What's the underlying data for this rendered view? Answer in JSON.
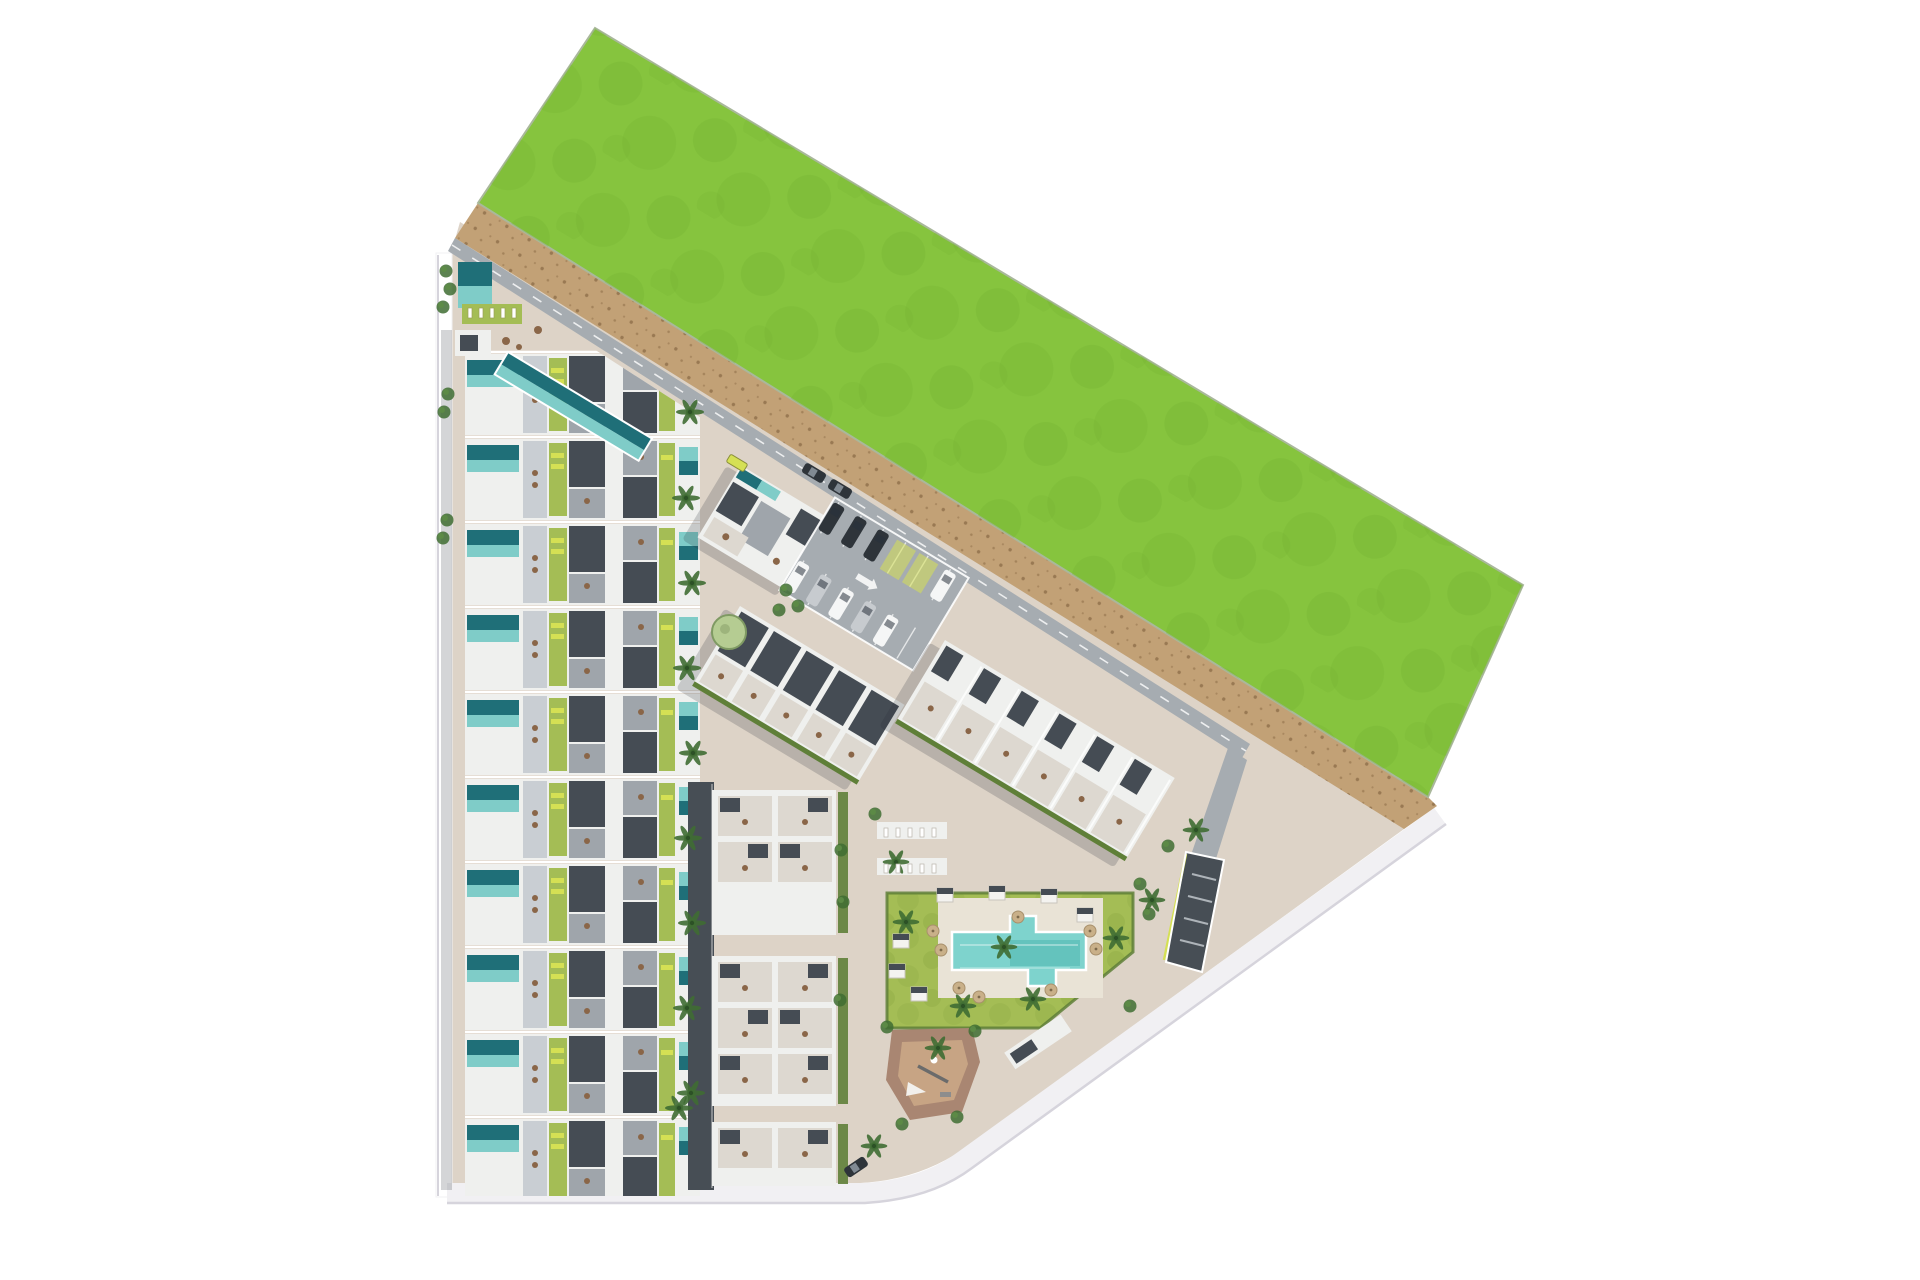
{
  "scene": {
    "name": "aerial-site-plan-rendering",
    "description": "Top-down 3D render of a coastal residential development: rows of townhouses with private pools on the left, rotated apartment blocks and parking in the centre, a communal lawn with swimming pool and playground on the right, a large green field to the north-east and a sandy dune strip along the boundary.",
    "width": 1920,
    "height": 1280
  },
  "colors": {
    "page_bg": "#ffffff",
    "grass": "#86c43e",
    "grass_dark": "#6fae2f",
    "sand": "#c2a176",
    "sand_dark": "#8f6f4a",
    "pavement": "#ddd3c7",
    "road_gray": "#a6acb1",
    "road_dark": "#474e55",
    "boundary_road": "#f1f0f3",
    "boundary_edge": "#d6d4dc",
    "roof_white": "#eff0ee",
    "roof_dark": "#454c54",
    "roof_mid": "#9fa5ab",
    "roof_light": "#c9ced3",
    "terrace": "#ddd8d0",
    "pool_dark": "#1f6f78",
    "pool_light": "#7fccc8",
    "big_pool": "#7ed3cd",
    "big_pool_deep": "#4fb7b0",
    "pool_deck": "#e9e3d6",
    "lawn": "#a4bd55",
    "lawn_dark": "#8aa743",
    "hedge": "#5f7f38",
    "tree_dark": "#3f6d33",
    "tree_pale": "#b5cc92",
    "accent": "#d5e054",
    "furniture_brown": "#8a6648",
    "playground_base": "#a98672",
    "playground_inner": "#c7a484",
    "umbrella": "#c9b089",
    "car_white": "#f5f6f6",
    "car_silver": "#c7cbcf",
    "car_dark": "#2e343a",
    "shadow": "rgba(40,45,55,0.20)"
  },
  "villas": {
    "rows": 10,
    "start_y": 352,
    "pitch": 85,
    "x": 465,
    "width": 235,
    "row_rects": [
      {
        "x": 0,
        "y": 2,
        "w": 235,
        "h": 81,
        "c": "f-rw"
      },
      {
        "x": 2,
        "y": 8,
        "w": 52,
        "h": 15,
        "c": "f-poold"
      },
      {
        "x": 2,
        "y": 23,
        "w": 52,
        "h": 12,
        "c": "f-pooll"
      },
      {
        "x": 58,
        "y": 4,
        "w": 24,
        "h": 77,
        "c": "f-rl"
      },
      {
        "x": 84,
        "y": 6,
        "w": 18,
        "h": 73,
        "c": "f-lawn"
      },
      {
        "x": 86,
        "y": 16,
        "w": 13,
        "h": 5,
        "c": "f-acc"
      },
      {
        "x": 86,
        "y": 27,
        "w": 13,
        "h": 5,
        "c": "f-acc"
      },
      {
        "x": 104,
        "y": 4,
        "w": 36,
        "h": 46,
        "c": "f-rd"
      },
      {
        "x": 104,
        "y": 52,
        "w": 36,
        "h": 29,
        "c": "f-rm"
      },
      {
        "x": 142,
        "y": 28,
        "w": 14,
        "h": 28,
        "c": "f-rw"
      },
      {
        "x": 158,
        "y": 4,
        "w": 34,
        "h": 34,
        "c": "f-rm"
      },
      {
        "x": 158,
        "y": 40,
        "w": 34,
        "h": 41,
        "c": "f-rd"
      },
      {
        "x": 194,
        "y": 6,
        "w": 16,
        "h": 73,
        "c": "f-lawn"
      },
      {
        "x": 196,
        "y": 18,
        "w": 12,
        "h": 5,
        "c": "f-acc"
      },
      {
        "x": 214,
        "y": 10,
        "w": 19,
        "h": 14,
        "c": "f-pooll"
      },
      {
        "x": 214,
        "y": 24,
        "w": 19,
        "h": 14,
        "c": "f-poold"
      }
    ],
    "row_dots": [
      [
        70,
        36
      ],
      [
        70,
        48
      ],
      [
        122,
        64
      ],
      [
        176,
        20
      ]
    ]
  },
  "decor": {
    "palms": [
      [
        690,
        412
      ],
      [
        686,
        498
      ],
      [
        692,
        583
      ],
      [
        687,
        668
      ],
      [
        693,
        753
      ],
      [
        688,
        838
      ],
      [
        692,
        923
      ],
      [
        687,
        1008
      ],
      [
        691,
        1093
      ],
      [
        679,
        1108
      ]
    ],
    "lawn_palms": [
      [
        1004,
        947
      ],
      [
        963,
        1006
      ],
      [
        1033,
        999
      ],
      [
        906,
        922
      ],
      [
        1116,
        938
      ],
      [
        938,
        1048
      ],
      [
        1152,
        900
      ],
      [
        874,
        1146
      ],
      [
        896,
        862
      ],
      [
        1196,
        830
      ]
    ],
    "round_trees": [
      [
        729,
        632
      ]
    ],
    "bushes": [
      [
        446,
        271
      ],
      [
        450,
        289
      ],
      [
        443,
        307
      ],
      [
        448,
        394
      ],
      [
        444,
        412
      ],
      [
        447,
        520
      ],
      [
        443,
        538
      ],
      [
        786,
        590
      ],
      [
        798,
        606
      ],
      [
        779,
        610
      ],
      [
        841,
        850
      ],
      [
        843,
        902
      ],
      [
        840,
        1000
      ],
      [
        1140,
        884
      ],
      [
        1149,
        914
      ],
      [
        1130,
        1006
      ],
      [
        975,
        1031
      ],
      [
        887,
        1027
      ],
      [
        902,
        1124
      ],
      [
        957,
        1117
      ],
      [
        1168,
        846
      ],
      [
        875,
        814
      ]
    ],
    "cabanas": [
      [
        945,
        895
      ],
      [
        997,
        893
      ],
      [
        1049,
        896
      ],
      [
        1085,
        915
      ],
      [
        901,
        941
      ],
      [
        897,
        971
      ],
      [
        919,
        994
      ]
    ],
    "umbrellas": [
      [
        933,
        931
      ],
      [
        941,
        950
      ],
      [
        1090,
        931
      ],
      [
        1096,
        949
      ],
      [
        959,
        988
      ],
      [
        979,
        997
      ],
      [
        1018,
        917
      ],
      [
        1051,
        990
      ]
    ],
    "pergola_loungers": {
      "x0": 884,
      "rows_y": [
        828,
        864
      ],
      "count": 5,
      "dx": 12
    },
    "strip_loungers": {
      "x0": 468,
      "y": 308,
      "count": 5,
      "dx": 11
    }
  },
  "parking": {
    "cars": [
      {
        "x": -70,
        "row": "top",
        "c": "car_dark"
      },
      {
        "x": -44,
        "row": "top",
        "c": "car_dark"
      },
      {
        "x": -18,
        "row": "top",
        "c": "car_dark"
      },
      {
        "x": 60,
        "row": "top",
        "c": "car_white"
      },
      {
        "x": -70,
        "row": "bottom",
        "c": "car_white"
      },
      {
        "x": -44,
        "row": "bottom",
        "c": "car_silver"
      },
      {
        "x": -18,
        "row": "bottom",
        "c": "car_white"
      },
      {
        "x": 8,
        "row": "bottom",
        "c": "car_silver"
      },
      {
        "x": 34,
        "row": "bottom",
        "c": "car_white"
      }
    ],
    "green_stalls": [
      8,
      34
    ]
  },
  "road_cars": [
    {
      "x": 814,
      "y": 473,
      "rot": 31,
      "c": "car_dark"
    },
    {
      "x": 840,
      "y": 489,
      "rot": 31,
      "c": "car_dark"
    },
    {
      "x": 856,
      "y": 1167,
      "rot": -34,
      "c": "car_dark"
    }
  ],
  "shuttle": {
    "x": 737,
    "y": 463,
    "rot": 31,
    "c": "accent"
  },
  "clusters": {
    "a_units": 2,
    "b_units": 5,
    "c_units": 6,
    "d_blocks": [
      {
        "y": 790,
        "h": 145
      },
      {
        "y": 956,
        "h": 150
      },
      {
        "y": 1122,
        "h": 64
      }
    ]
  }
}
